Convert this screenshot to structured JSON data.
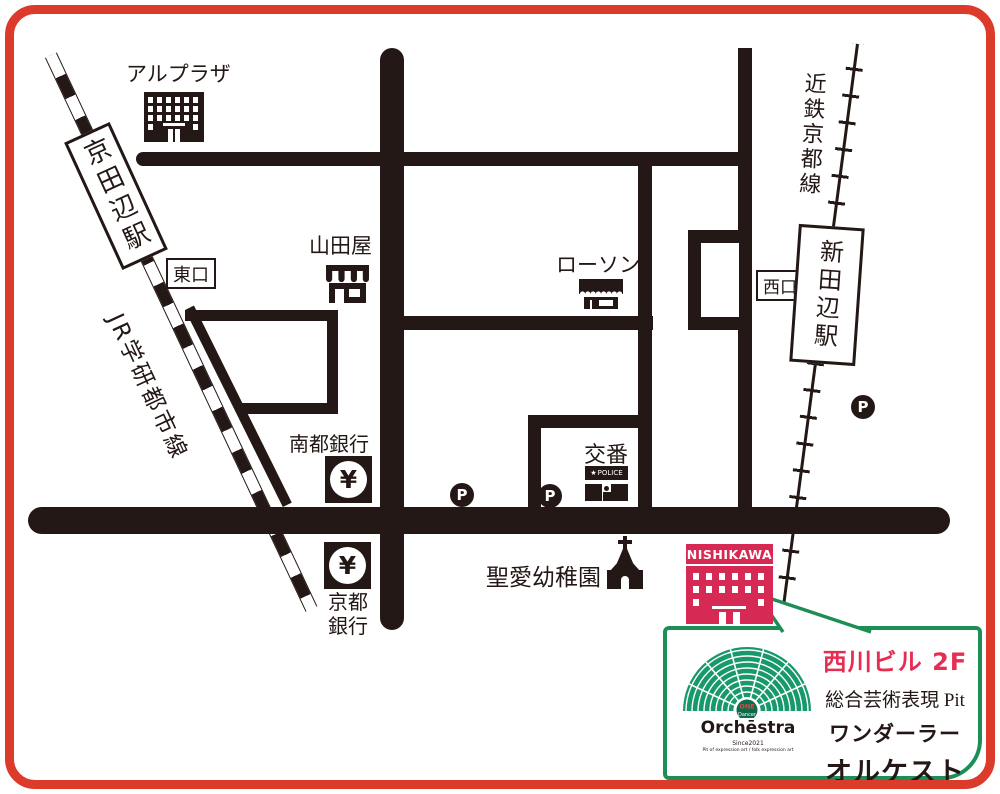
{
  "map": {
    "stations": {
      "kyotanabe": "京田辺駅",
      "shintanabe": "新田辺駅",
      "jr_line": "JR学研都市線",
      "kintetsu_line": "近鉄京都線",
      "east_exit": "東口",
      "west_exit": "西口"
    },
    "labels": {
      "alplaza": "アルプラザ",
      "yamadaya": "山田屋",
      "lawson": "ローソン",
      "nanto_bank": "南都銀行",
      "kyoto_bank_l1": "京都",
      "kyoto_bank_l2": "銀行",
      "koban": "交番",
      "police": "POLICE",
      "seiai": "聖愛幼稚園",
      "parking": "P",
      "yen": "¥",
      "nishikawa_sign": "NISHIKAWA"
    },
    "icons": {
      "police_star": "★"
    }
  },
  "callout": {
    "building_floor": "西川ビル 2F",
    "org_type": "総合芸術表現 Pit",
    "name_line1": "ワンダーラー",
    "name_line2": "オルケストラ",
    "logo": {
      "badge_top": "ONE",
      "badge_bottom": "Dancer",
      "wordmark": "Orchēstra",
      "tagline1": "Since2021",
      "tagline2": "Pit of expression art / folk expression art"
    }
  },
  "colors": {
    "ink": "#231815",
    "frame_red": "#dc3b2c",
    "nishikawa_red": "#d62a55",
    "title_red": "#e62e53",
    "box_green": "#1e8e57",
    "fan_green": "#18996b"
  }
}
